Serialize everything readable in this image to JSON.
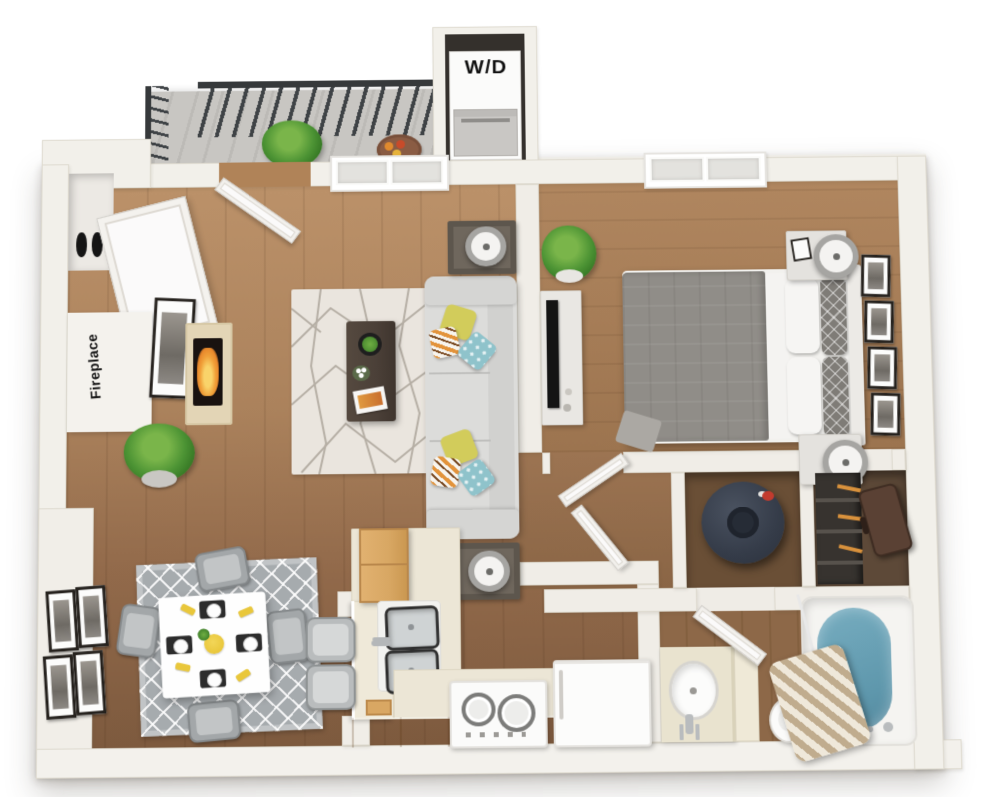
{
  "labels": {
    "washer_dryer": "W/D",
    "fireplace": "Fireplace"
  },
  "palette": {
    "wall": "#f0ede7",
    "wall_shade": "#dedacf",
    "floor_living": "#b3895f",
    "floor_kitchen": "#7d5a3e",
    "floor_bedroom": "#a87f58",
    "balcony_concrete": "#c5c3bf",
    "railing": "#3a3d3f",
    "rug_living": "#eae5de",
    "rug_living_lines": "#b5aea4",
    "rug_dining": "#a6abae",
    "sofa": "#dcdcda",
    "pillow_yellow": "#d2cc5b",
    "pillow_teal": "#8fc3cb",
    "pillow_orange": "#e2933b",
    "coffee_table": "#4b4038",
    "bed_duvet": "#908d88",
    "counter": "#ece6d6",
    "cabinet_wood": "#d8a763",
    "appliance_white": "#fbfbfa",
    "tub_water": "#6ea6ba",
    "curtain_stripe": "#c0ac8e",
    "water_heater": "#3a414e",
    "flame": "#e8872b",
    "suitcase": "#5a4134"
  },
  "rooms": [
    {
      "name": "balcony",
      "items": [
        "railing",
        "potted-plant",
        "serving-tray"
      ]
    },
    {
      "name": "laundry-closet",
      "items": [
        "washer-dryer-unit"
      ]
    },
    {
      "name": "living-room",
      "items": [
        "entry-door",
        "window",
        "coat-closet-door",
        "shoe-closet",
        "fireplace",
        "framed-art",
        "potted-plant",
        "area-rug",
        "coffee-table",
        "sofa",
        "throw-pillows",
        "side-tables",
        "table-lamps"
      ]
    },
    {
      "name": "bedroom",
      "items": [
        "window",
        "bed",
        "duvet",
        "pillows",
        "headboard",
        "nightstands",
        "table-lamps",
        "tv-dresser",
        "tv",
        "potted-plant",
        "wall-frames"
      ]
    },
    {
      "name": "dining-area",
      "items": [
        "area-rug",
        "dining-table",
        "dining-chairs",
        "place-settings",
        "wall-frames"
      ]
    },
    {
      "name": "kitchen",
      "items": [
        "bar-counter",
        "bar-stools",
        "upper-cabinet",
        "double-sink",
        "range",
        "refrigerator",
        "base-cabinets"
      ]
    },
    {
      "name": "hallway",
      "items": [
        "bedroom-door",
        "closet-door"
      ]
    },
    {
      "name": "water-heater-closet",
      "items": [
        "water-heater"
      ]
    },
    {
      "name": "walk-in-closet",
      "items": [
        "shelving",
        "hangers",
        "suitcase"
      ]
    },
    {
      "name": "bathroom",
      "items": [
        "vanity-sink",
        "toilet",
        "bathtub",
        "shower-curtain",
        "bathroom-door"
      ]
    }
  ]
}
